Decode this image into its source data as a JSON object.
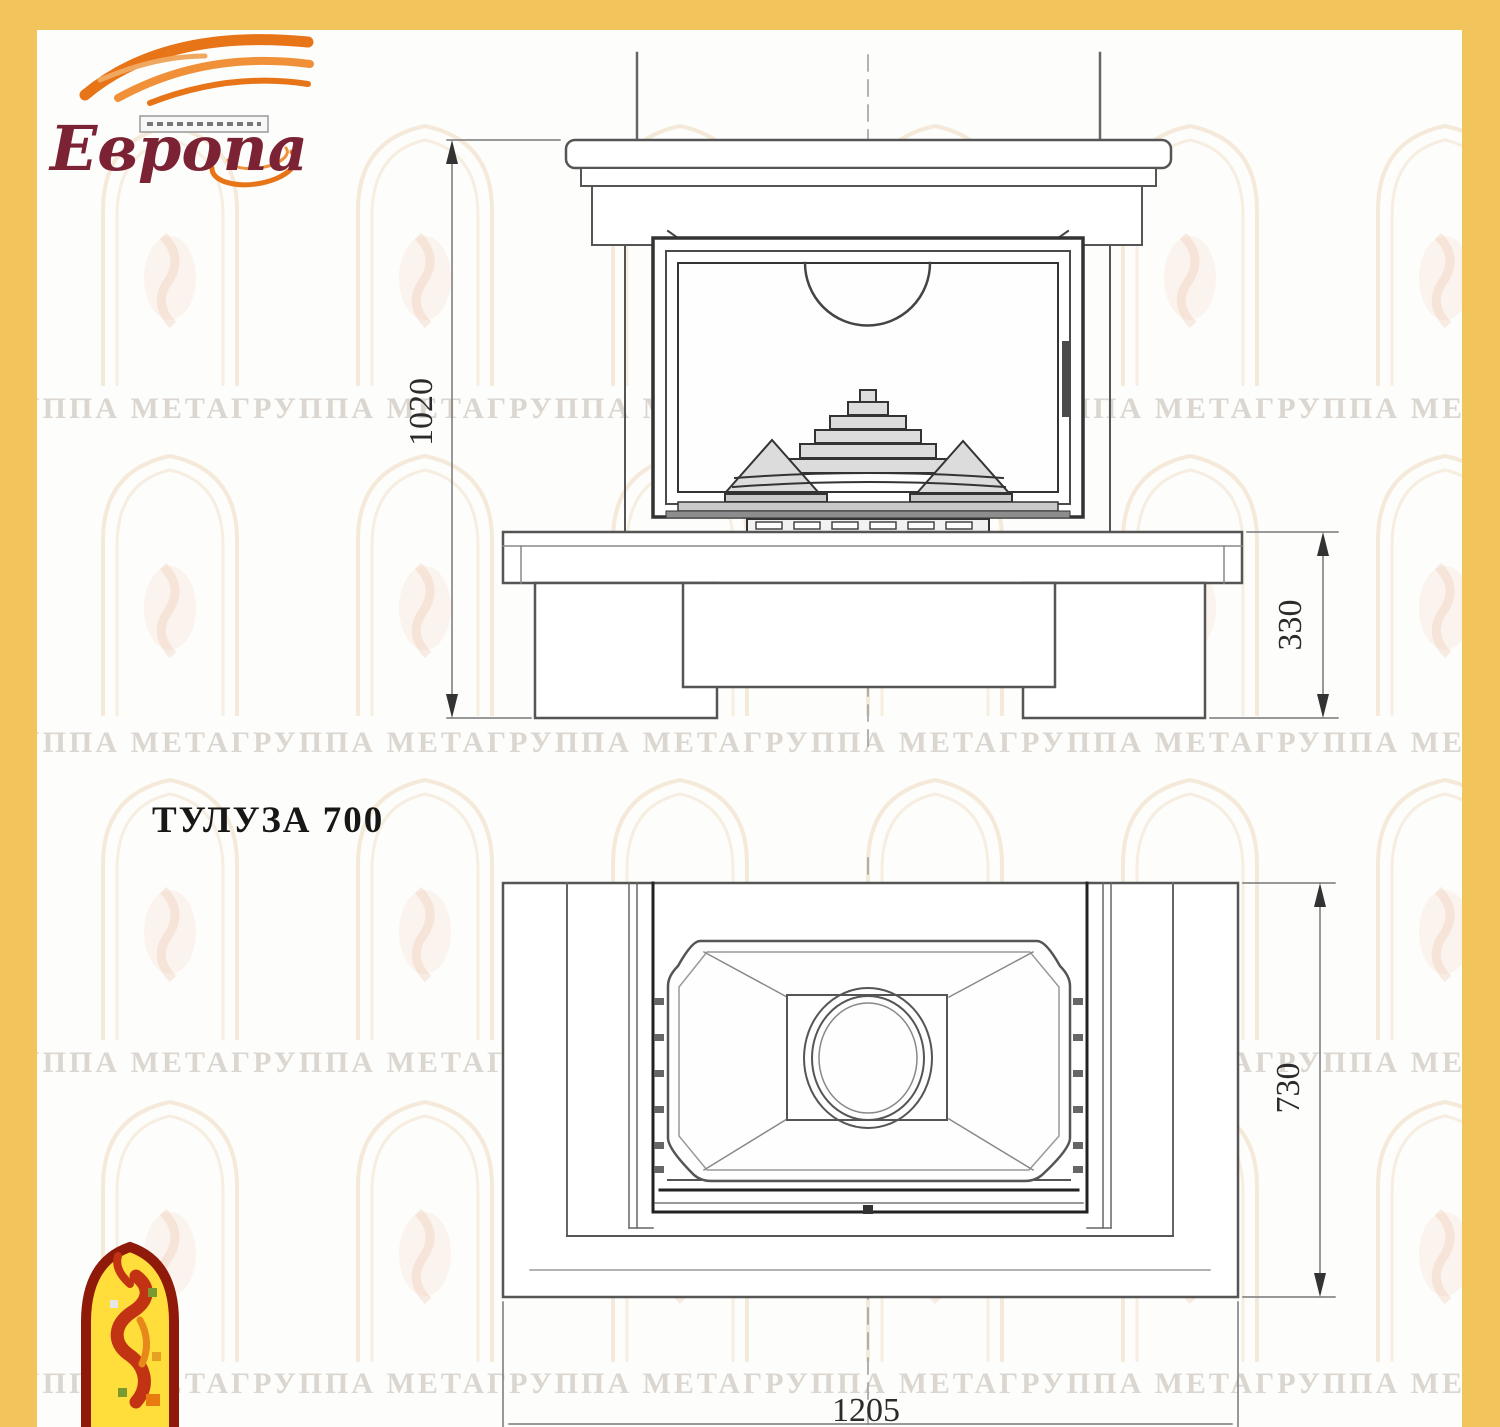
{
  "page": {
    "frame_color": "#F2C45C",
    "paper_color": "#FDFDFB"
  },
  "logo_europa": {
    "text": "Европа",
    "text_color": "#7B2335",
    "flame_color": "#E87418"
  },
  "title": "ТУЛУЗА 700",
  "watermark": {
    "row_text": "ГРУППА МЕТАГРУППА МЕТАГРУППА МЕТАГРУППА МЕТАГРУППА МЕТАГРУППА МЕТАГРУППА МЕТА",
    "color": "#ACA094"
  },
  "front_view": {
    "height_label": "1020",
    "base_label": "330"
  },
  "plan_view": {
    "depth_label": "730",
    "width_label": "1205"
  }
}
